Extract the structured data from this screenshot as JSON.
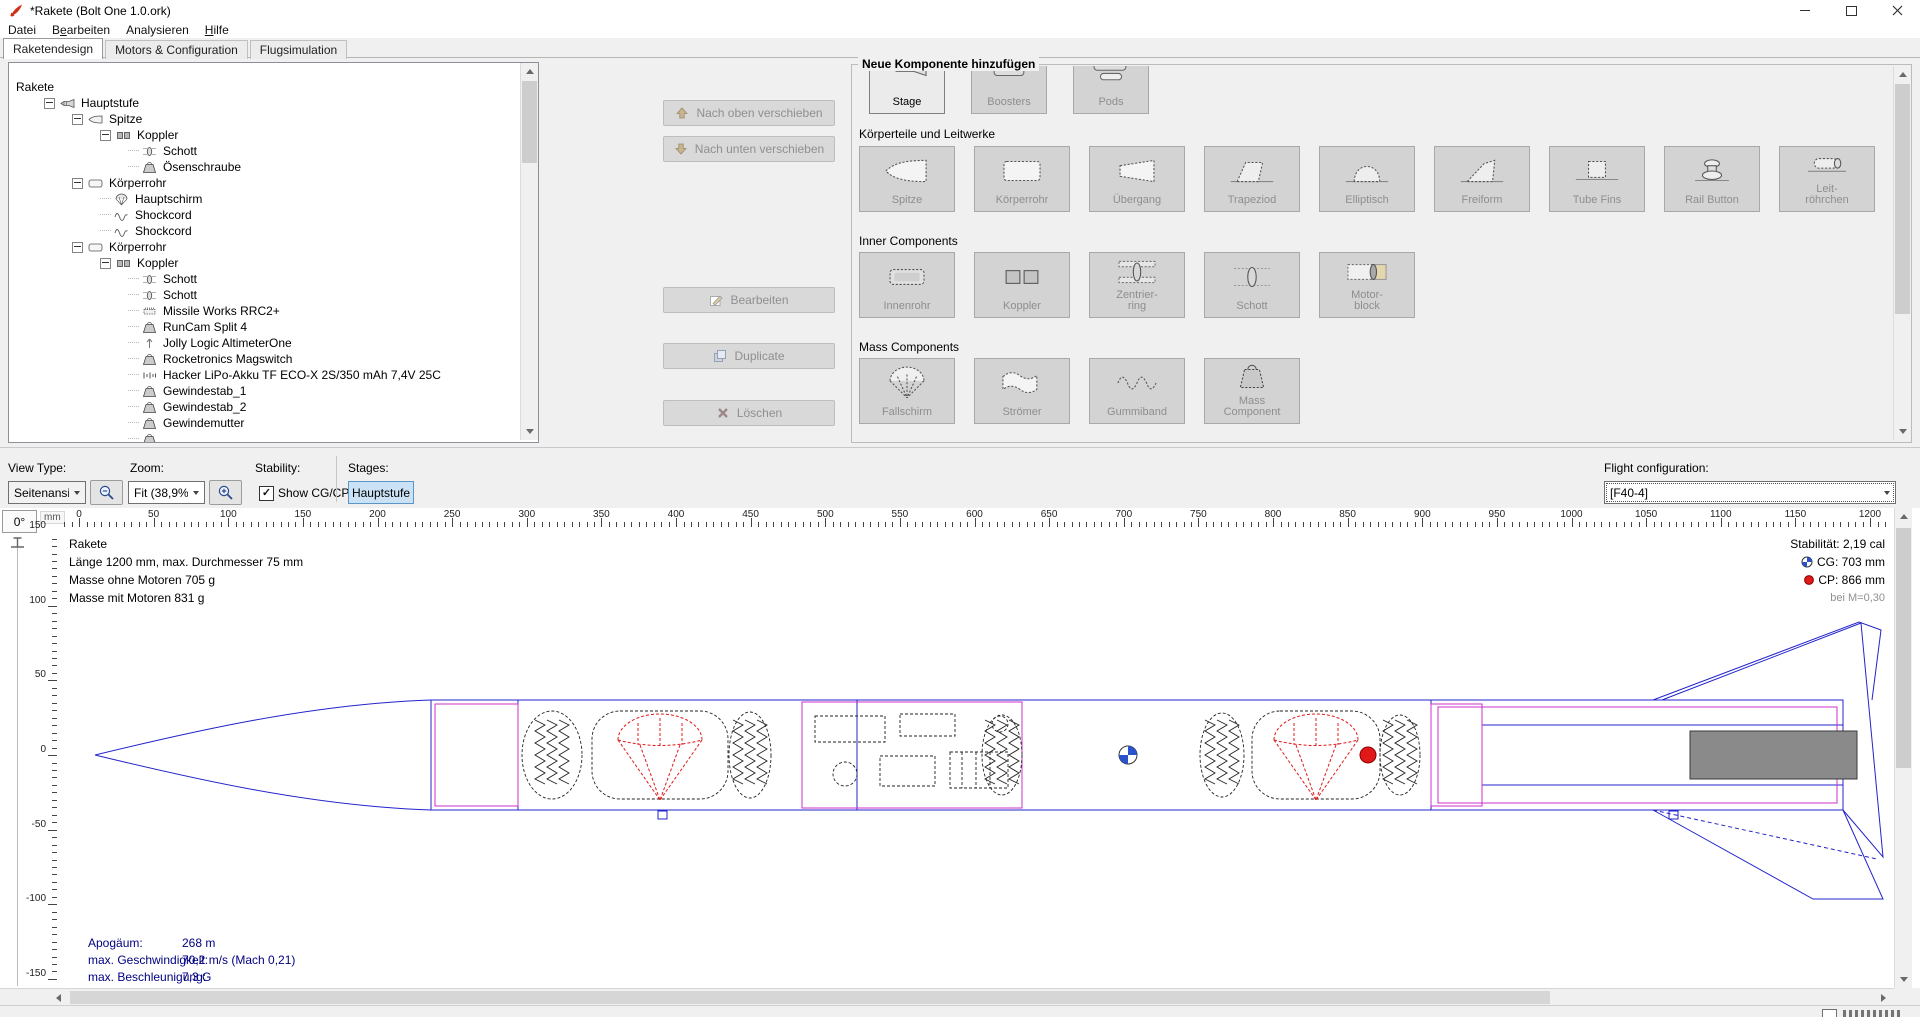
{
  "window": {
    "title": "*Rakete (Bolt One 1.0.ork)",
    "controls": [
      "minimize",
      "maximize",
      "close"
    ]
  },
  "menu": {
    "items": [
      {
        "pre": "Datei",
        "mn": "",
        "post": ""
      },
      {
        "pre": "B",
        "mn": "e",
        "post": "arbeiten"
      },
      {
        "pre": "Analysieren",
        "mn": "",
        "post": ""
      },
      {
        "pre": "",
        "mn": "H",
        "post": "ilfe"
      }
    ]
  },
  "tabs": [
    {
      "label": "Raketendesign",
      "active": true
    },
    {
      "label": "Motors & Configuration",
      "active": false
    },
    {
      "label": "Flugsimulation",
      "active": false
    }
  ],
  "tree": {
    "items": [
      {
        "depth": 0,
        "icon": "",
        "label": "Rakete",
        "expander": false
      },
      {
        "depth": 1,
        "icon": "rocket",
        "label": "Hauptstufe",
        "expander": true
      },
      {
        "depth": 2,
        "icon": "nosecone",
        "label": "Spitze",
        "expander": true
      },
      {
        "depth": 3,
        "icon": "coupler",
        "label": "Koppler",
        "expander": true
      },
      {
        "depth": 4,
        "icon": "bulkhead",
        "label": "Schott",
        "expander": false
      },
      {
        "depth": 4,
        "icon": "mass",
        "label": "Ösenschraube",
        "expander": false
      },
      {
        "depth": 2,
        "icon": "bodytube",
        "label": "Körperrohr",
        "expander": true
      },
      {
        "depth": 3,
        "icon": "parachute",
        "label": "Hauptschirm",
        "expander": false
      },
      {
        "depth": 3,
        "icon": "shockcord",
        "label": "Shockcord",
        "expander": false
      },
      {
        "depth": 3,
        "icon": "shockcord",
        "label": "Shockcord",
        "expander": false
      },
      {
        "depth": 2,
        "icon": "bodytube",
        "label": "Körperrohr",
        "expander": true
      },
      {
        "depth": 3,
        "icon": "coupler",
        "label": "Koppler",
        "expander": true
      },
      {
        "depth": 4,
        "icon": "bulkhead",
        "label": "Schott",
        "expander": false
      },
      {
        "depth": 4,
        "icon": "bulkhead",
        "label": "Schott",
        "expander": false
      },
      {
        "depth": 4,
        "icon": "board",
        "label": "Missile Works RRC2+",
        "expander": false
      },
      {
        "depth": 4,
        "icon": "mass",
        "label": "RunCam Split 4",
        "expander": false
      },
      {
        "depth": 4,
        "icon": "altimeter",
        "label": "Jolly Logic AltimeterOne",
        "expander": false
      },
      {
        "depth": 4,
        "icon": "mass",
        "label": "Rocketronics Magswitch",
        "expander": false
      },
      {
        "depth": 4,
        "icon": "battery",
        "label": "Hacker LiPo-Akku TF ECO-X 2S/350 mAh 7,4V 25C",
        "expander": false
      },
      {
        "depth": 4,
        "icon": "mass",
        "label": "Gewindestab_1",
        "expander": false
      },
      {
        "depth": 4,
        "icon": "mass",
        "label": "Gewindestab_2",
        "expander": false
      },
      {
        "depth": 4,
        "icon": "mass",
        "label": "Gewindemutter",
        "expander": false
      },
      {
        "depth": 4,
        "icon": "mass",
        "label": "",
        "expander": false,
        "partial": true
      }
    ]
  },
  "actions": {
    "move_up": "Nach oben verschieben",
    "move_down": "Nach unten verschieben",
    "edit": "Bearbeiten",
    "duplicate": "Duplicate",
    "delete": "Löschen"
  },
  "palette": {
    "title": "Neue Komponente hinzufügen",
    "top_row": [
      {
        "label": "Stage",
        "icon": "stage",
        "enabled": true
      },
      {
        "label": "Boosters",
        "icon": "boosters",
        "enabled": false
      },
      {
        "label": "Pods",
        "icon": "pods",
        "enabled": false
      }
    ],
    "sections": [
      {
        "label": "Körperteile und Leitwerke",
        "buttons": [
          {
            "label": "Spitze",
            "icon": "nosecone"
          },
          {
            "label": "Körperrohr",
            "icon": "bodytube"
          },
          {
            "label": "Übergang",
            "icon": "transition"
          },
          {
            "label": "Trapeziod",
            "icon": "fin_trap"
          },
          {
            "label": "Elliptisch",
            "icon": "fin_ell"
          },
          {
            "label": "Freiform",
            "icon": "fin_free"
          },
          {
            "label": "Tube Fins",
            "icon": "tube_fins"
          },
          {
            "label": "Rail Button",
            "icon": "rail_button"
          },
          {
            "label": "Leit-\nröhrchen",
            "icon": "launch_lug"
          }
        ]
      },
      {
        "label": "Inner Components",
        "buttons": [
          {
            "label": "Innenrohr",
            "icon": "inner_tube"
          },
          {
            "label": "Koppler",
            "icon": "coupler"
          },
          {
            "label": "Zentrier-\nring",
            "icon": "centering_ring"
          },
          {
            "label": "Schott",
            "icon": "bulkhead"
          },
          {
            "label": "Motor-\nblock",
            "icon": "engine_block"
          }
        ]
      },
      {
        "label": "Mass Components",
        "buttons": [
          {
            "label": "Fallschirm",
            "icon": "parachute"
          },
          {
            "label": "Strömer",
            "icon": "streamer"
          },
          {
            "label": "Gummiband",
            "icon": "shock_cord"
          },
          {
            "label": "Mass\nComponent",
            "icon": "mass"
          }
        ]
      }
    ]
  },
  "toolbar": {
    "view_type_label": "View Type:",
    "view_type_value": "Seitenansicht",
    "zoom_label": "Zoom:",
    "zoom_value": "Fit (38,9%)",
    "stability_label": "Stability:",
    "show_cgcp_label": "Show CG/CP",
    "show_cgcp_checked": true,
    "stages_label": "Stages:",
    "stage_button": "Hauptstufe",
    "flight_config_label": "Flight configuration:",
    "flight_config_value": "[F40-4]"
  },
  "canvas": {
    "rotation": "0°",
    "unit": "mm",
    "hruler_labels": [
      0,
      50,
      100,
      150,
      200,
      250,
      300,
      350,
      400,
      450,
      500,
      550,
      600,
      650,
      700,
      750,
      800,
      850,
      900,
      950,
      1000,
      1050,
      1100,
      1150,
      1200
    ],
    "vru­ler_note": "vertical ruler labels",
    "vruler_labels": [
      150,
      100,
      50,
      0,
      -50,
      -100,
      -150
    ],
    "info_lines": [
      "Rakete",
      "Länge 1200 mm, max. Durchmesser 75 mm",
      "Masse ohne Motoren 705 g",
      "Masse mit Motoren 831 g"
    ],
    "stability": {
      "stability_text": "Stabilität: 2,19 cal",
      "cg_text": "CG: 703 mm",
      "cp_text": "CP: 866 mm",
      "mach_text": "bei M=0,30"
    },
    "sim_stats": [
      {
        "label": "Apogäum:",
        "value": "268 m"
      },
      {
        "label": "max. Geschwindigkeit:",
        "value": "70,2 m/s  (Mach 0,21)"
      },
      {
        "label": "max. Beschleunigung:",
        "value": "7,3 G"
      }
    ],
    "cg_mm": 703,
    "cp_mm": 866,
    "length_mm": 1200
  },
  "colors": {
    "rocket_outline": "#2323cc",
    "coupler_outline": "#cc2fcc",
    "event_red": "#e01818",
    "sim_text": "#000080",
    "stage_button_bg": "#cbe2f6",
    "stage_button_border": "#5a96c8",
    "motor_fill": "#8a8a8a",
    "window_bg": "#f0f0f0"
  }
}
